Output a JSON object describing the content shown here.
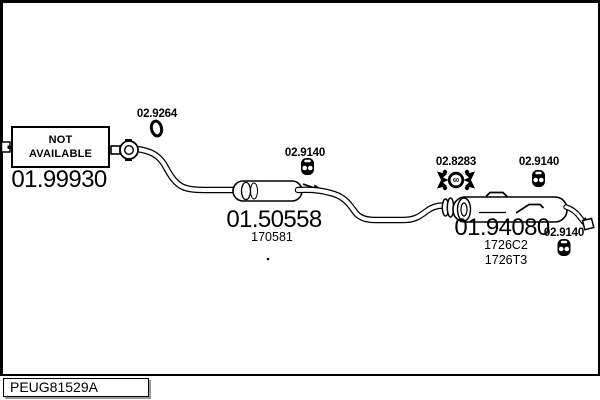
{
  "colors": {
    "ink": "#000000",
    "paper": "#ffffff",
    "box_shadow": "#9c9c9c"
  },
  "not_available": {
    "line1": "NOT",
    "line2": "AVAILABLE",
    "part_number": "01.99930"
  },
  "parts": {
    "gasket_front": {
      "id": "02.9264",
      "icon": "o-ring-gasket-icon"
    },
    "hanger_mid": {
      "id": "02.9140",
      "icon": "rubber-hanger-icon"
    },
    "mount_rear": {
      "id": "02.8283",
      "icon": "rubber-mount-icon",
      "mount_size": "60"
    },
    "hanger_rear": {
      "id": "02.9140",
      "icon": "rubber-hanger-icon"
    },
    "hanger_tail": {
      "id": "02.9140",
      "icon": "rubber-hanger-icon"
    },
    "centre_silencer": {
      "id": "01.50558",
      "oe_ref": "170581"
    },
    "rear_silencer": {
      "id": "01.94080",
      "oe_ref_1": "1726C2",
      "oe_ref_2": "1726T3"
    }
  },
  "footer": {
    "drawing_code": "PEUG81529A"
  }
}
